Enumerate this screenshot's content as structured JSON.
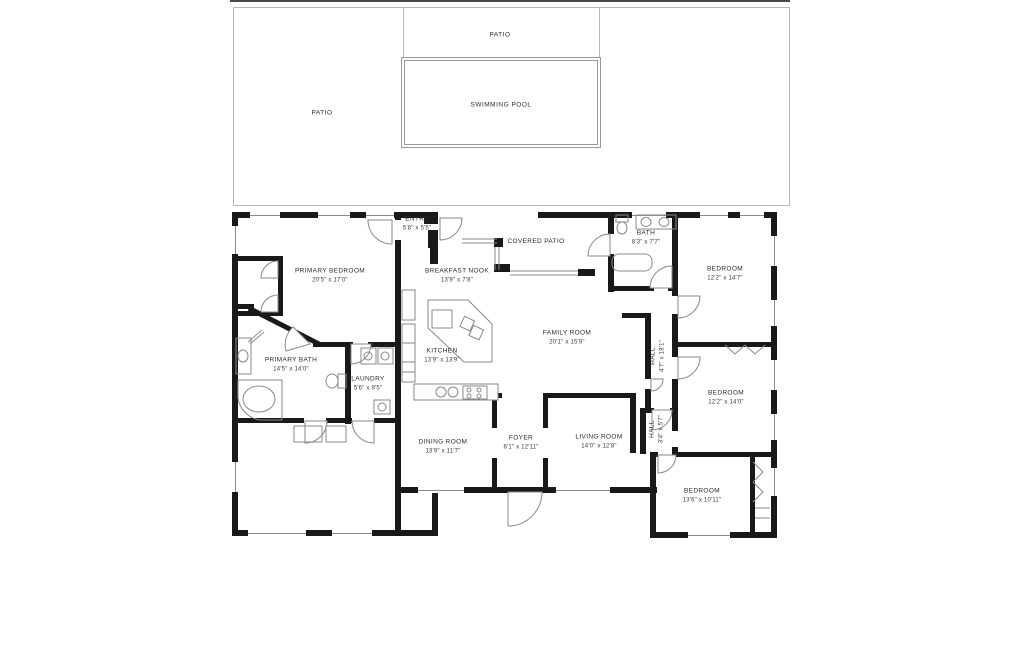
{
  "plan": {
    "outdoor": {
      "patio_left": "PATIO",
      "patio_top": "PATIO",
      "pool": "SWIMMING POOL"
    },
    "rooms": [
      {
        "id": "entry",
        "name": "ENTRY",
        "dims": "5'8\" x 5'5\""
      },
      {
        "id": "covered-patio",
        "name": "COVERED PATIO",
        "dims": ""
      },
      {
        "id": "bath",
        "name": "BATH",
        "dims": "8'3\" x 7'7\""
      },
      {
        "id": "primary-bedroom",
        "name": "PRIMARY BEDROOM",
        "dims": "20'5\" x 17'0\""
      },
      {
        "id": "breakfast-nook",
        "name": "BREAKFAST NOOK",
        "dims": "13'9\" x 7'8\""
      },
      {
        "id": "bedroom-top-right",
        "name": "BEDROOM",
        "dims": "12'2\" x 14'7\""
      },
      {
        "id": "family-room",
        "name": "FAMILY ROOM",
        "dims": "20'1\" x 15'9\""
      },
      {
        "id": "kitchen",
        "name": "KITCHEN",
        "dims": "13'9\" x 13'9\""
      },
      {
        "id": "hall",
        "name": "HALL",
        "dims": "4'7\" x 18'1\""
      },
      {
        "id": "primary-bath",
        "name": "PRIMARY BATH",
        "dims": "14'5\" x 14'0\""
      },
      {
        "id": "laundry",
        "name": "LAUNDRY",
        "dims": "5'6\" x 9'5\""
      },
      {
        "id": "bedroom-mid-right",
        "name": "BEDROOM",
        "dims": "12'2\" x 14'0\""
      },
      {
        "id": "dining-room",
        "name": "DINING ROOM",
        "dims": "13'9\" x 11'7\""
      },
      {
        "id": "foyer",
        "name": "FOYER",
        "dims": "6'1\" x 12'11\""
      },
      {
        "id": "living-room",
        "name": "LIVING ROOM",
        "dims": "14'0\" x 12'8\""
      },
      {
        "id": "hall-small",
        "name": "HALL",
        "dims": "3'4\" x 5'7\""
      },
      {
        "id": "bedroom-bottom-right",
        "name": "BEDROOM",
        "dims": "13'6\" x 10'11\""
      }
    ],
    "colors": {
      "wall": "#191919",
      "line": "#8a8a8a",
      "background": "#ffffff"
    }
  }
}
